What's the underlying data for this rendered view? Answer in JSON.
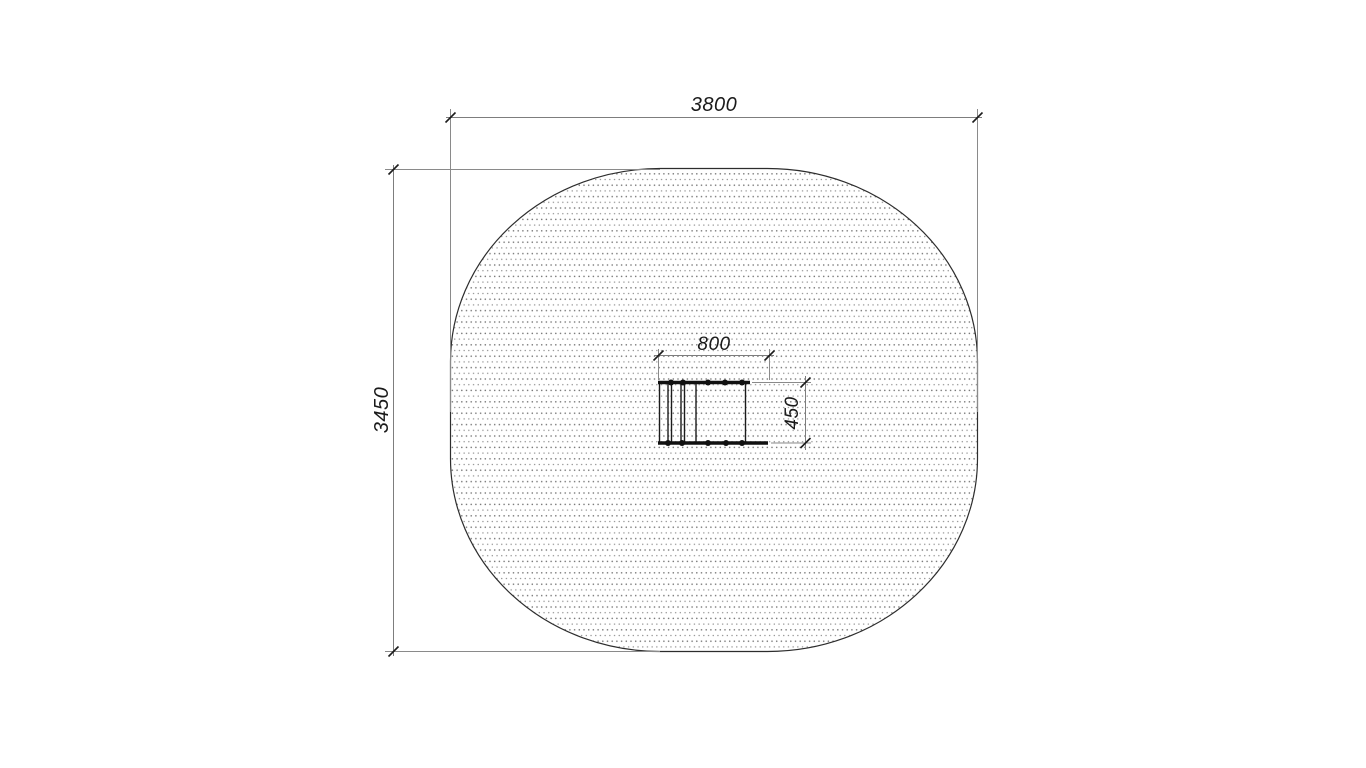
{
  "drawing": {
    "labels": {
      "zone_width": "3800",
      "zone_height": "3450",
      "item_width": "800",
      "item_depth": "450"
    },
    "colors": {
      "background": "#ffffff",
      "zone_outline": "#2d2d2d",
      "dimension_line": "#7d7d7d",
      "extension_line": "#8a8a8a",
      "tick_mark": "#1c1c1c",
      "label_text": "#1a1a1a",
      "stipple_dot": "#757575",
      "equipment": "#111111"
    }
  }
}
